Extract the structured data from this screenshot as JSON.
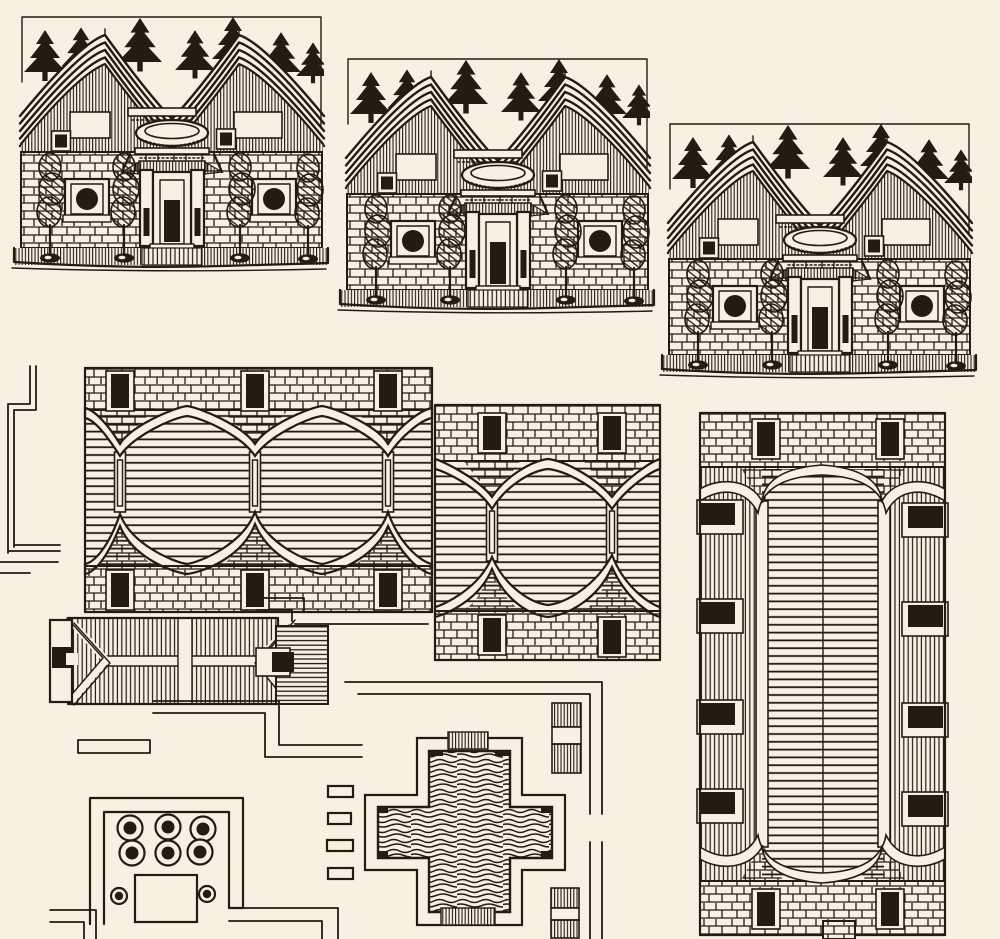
{
  "meta": {
    "title": "Ink drawing sheet — Chinese courtyard houses",
    "medium": "pen and ink on cream paper",
    "alt": "Hand-drawn pen-and-ink illustration: three repeated elevations of traditional stone houses with sweeping tiled roofs and pine trees behind them, above a site plan showing tiled roof halls from overhead, a hip-roofed hall, a walled garden court with potted plants, and a cross-shaped pond with rippling water."
  },
  "palette": {
    "paper": "#f7f1e3",
    "ink": "#241b11"
  },
  "figures": {
    "facade_row": {
      "label": "Row of three identical house facade elevations, stepping down left to right",
      "count": 3
    },
    "facade": {
      "label": "House facade: double concave tiled roof, seven pine trees behind, stone block wall, two round windows, ornate central doorway with curved canopy, four potted trees, hatched ground strip",
      "pines": 7,
      "potted_trees": 4,
      "round_windows": 2
    },
    "roof_plan_large": {
      "label": "Overhead plan of a long three-bay tiled roof hall with brick walls and doorways top and bottom",
      "bays": 3,
      "doors_top": 3,
      "doors_bottom": 3
    },
    "roof_plan_small": {
      "label": "Overhead plan of a two-bay tiled roof hall with brick walls and doorways",
      "bays": 2,
      "doors_top": 2,
      "doors_bottom": 2
    },
    "great_hall_plan": {
      "label": "Tall overhead plan of a great hall: long arched tile roof with side aisles, windows along both sides, brick end walls with two doors each",
      "side_windows": 8,
      "doors": 4
    },
    "hip_roof_hall": {
      "label": "Overhead plan of a small hip-roofed hall with ridge, hips and end porches"
    },
    "garden_court": {
      "label": "Walled garden court with six large planters, two small planters and a square pavilion",
      "planters": 6,
      "small_planters": 2
    },
    "cross_pond": {
      "label": "Cross-shaped pond with rippling water and hatched steps at top and bottom"
    },
    "paths": {
      "label": "Thin double-line courtyard walls, paths and stepped walks"
    },
    "steps": {
      "label": "Small hatched stair blocks and stepping stones"
    }
  }
}
